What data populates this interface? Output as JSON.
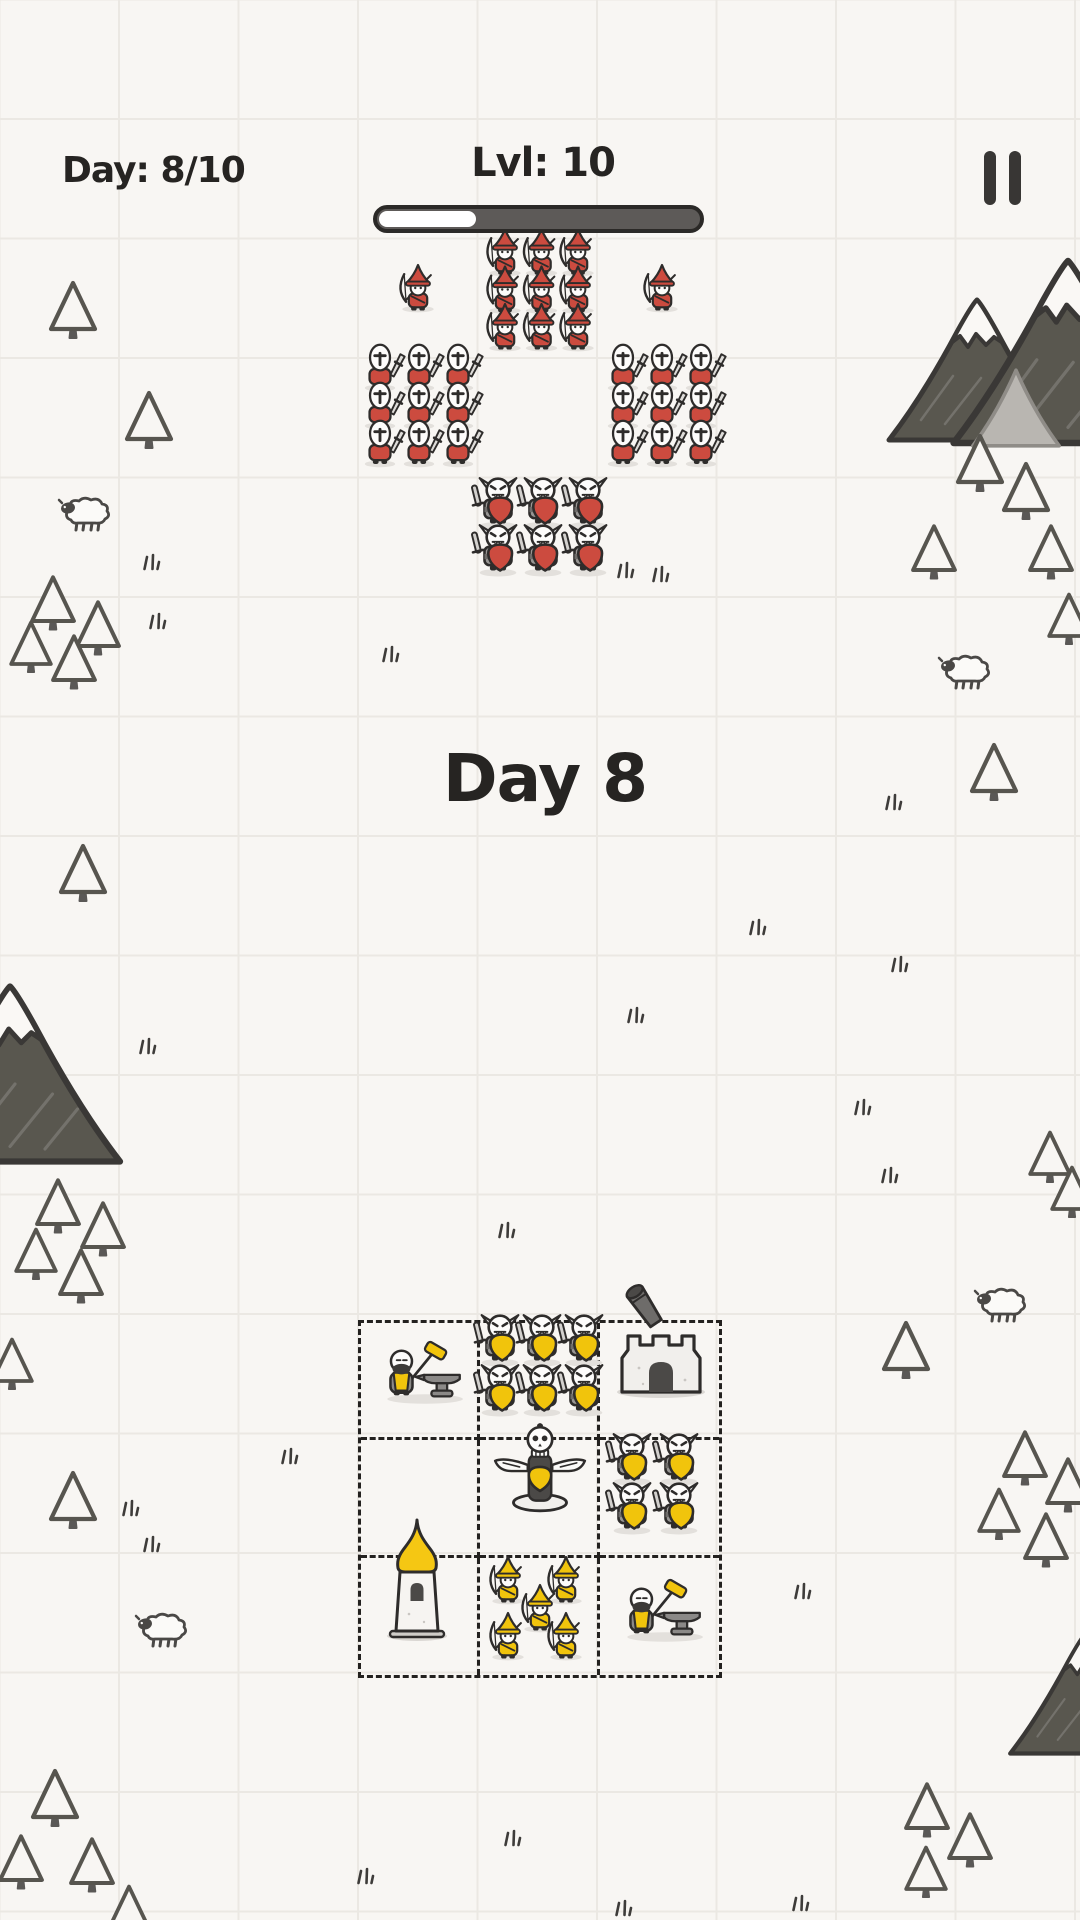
{
  "hud": {
    "day_counter": "Day: 8/10",
    "level_label": "Lvl: 10",
    "level_progress_percent": 30,
    "pause_icon": "pause"
  },
  "banner": {
    "day_title": "Day 8"
  },
  "colors": {
    "paper": "#f8f6f3",
    "grid_line": "#ebe8e3",
    "ink": "#2e2c2b",
    "enemy_red": "#cc4b3f",
    "player_yellow": "#f1c40c",
    "bar_track": "#5d5a58",
    "bar_fill": "#ffffff",
    "bar_border": "#2b2927"
  },
  "board": {
    "x": 358,
    "y": 1320,
    "width": 364,
    "height": 358,
    "rows": 3,
    "cols": 3,
    "cells": [
      [
        "blacksmith",
        "shield-warriors-x6",
        "cannon-tower"
      ],
      [
        "empty",
        "skull-totem",
        "shield-warriors-x4"
      ],
      [
        "spire-tower",
        "archers-x5",
        "blacksmith"
      ]
    ]
  },
  "units": [
    {
      "name": "enemy-archer",
      "type": "archer",
      "color": "#cc4b3f",
      "x": 505,
      "y": 252,
      "cols": 3,
      "rows": 3,
      "dx": 36.5,
      "dy": 37.5,
      "s": 0.92,
      "interactable": false
    },
    {
      "name": "enemy-archer-flank-left",
      "type": "archer",
      "color": "#cc4b3f",
      "x": 418,
      "y": 288,
      "s": 0.92,
      "interactable": false
    },
    {
      "name": "enemy-archer-flank-right",
      "type": "archer",
      "color": "#cc4b3f",
      "x": 662,
      "y": 288,
      "s": 0.92,
      "interactable": false
    },
    {
      "name": "enemy-swordsman-left",
      "type": "swordsman",
      "color": "#cc4b3f",
      "x": 380,
      "y": 368,
      "cols": 3,
      "rows": 3,
      "dx": 39,
      "dy": 38,
      "s": 0.95,
      "interactable": false
    },
    {
      "name": "enemy-swordsman-right",
      "type": "swordsman",
      "color": "#cc4b3f",
      "x": 623,
      "y": 368,
      "cols": 3,
      "rows": 3,
      "dx": 39,
      "dy": 38,
      "s": 0.95,
      "interactable": false
    },
    {
      "name": "enemy-shield-warrior",
      "type": "orc",
      "color": "#cc4b3f",
      "x": 498,
      "y": 503,
      "cols": 3,
      "rows": 2,
      "dx": 45,
      "dy": 47,
      "s": 1.08,
      "interactable": false
    },
    {
      "name": "player-blacksmith",
      "type": "blacksmith",
      "x": 423,
      "y": 1378,
      "s": 1.05,
      "interactable": true
    },
    {
      "name": "player-shield-warrior-squad6",
      "type": "orc",
      "color": "#f1c40c",
      "x": 500,
      "y": 1340,
      "cols": 3,
      "rows": 2,
      "dx": 42,
      "dy": 50,
      "s": 1.08,
      "interactable": true
    },
    {
      "name": "player-cannon-tower",
      "type": "cannon-tower",
      "x": 661,
      "y": 1356,
      "s": 1,
      "interactable": true
    },
    {
      "name": "player-skull-totem",
      "type": "totem",
      "x": 540,
      "y": 1469,
      "s": 1.02,
      "interactable": true
    },
    {
      "name": "player-shield-warrior-squad4",
      "type": "orc",
      "color": "#f1c40c",
      "x": 632,
      "y": 1459,
      "cols": 2,
      "rows": 2,
      "dx": 47,
      "dy": 49,
      "s": 1.08,
      "interactable": true
    },
    {
      "name": "player-spire-tower",
      "type": "spire-tower",
      "x": 417,
      "y": 1584,
      "s": 1,
      "interactable": true
    },
    {
      "name": "player-archer-squad5",
      "type": "archer",
      "color": "#f1c40c",
      "points": [
        [
          508,
          1580
        ],
        [
          566,
          1580
        ],
        [
          540,
          1608
        ],
        [
          508,
          1636
        ],
        [
          566,
          1636
        ]
      ],
      "s": 0.92,
      "interactable": true
    },
    {
      "name": "player-blacksmith-2",
      "type": "blacksmith",
      "x": 663,
      "y": 1616,
      "s": 1.05,
      "interactable": true
    }
  ],
  "decorations": {
    "mountains": [
      {
        "x": 977,
        "y": 370,
        "s": 1.0
      },
      {
        "x": 1068,
        "y": 352,
        "s": 1.3
      },
      {
        "x": 1016,
        "y": 408,
        "s": 0.9,
        "light": true
      },
      {
        "x": 10,
        "y": 1074,
        "s": 1.25
      },
      {
        "x": 1085,
        "y": 1694,
        "s": 0.85
      }
    ],
    "trees": [
      [
        73,
        309,
        1
      ],
      [
        149,
        419,
        1
      ],
      [
        53,
        602,
        0.95
      ],
      [
        98,
        627,
        0.95
      ],
      [
        31,
        646,
        0.9
      ],
      [
        74,
        661,
        0.95
      ],
      [
        980,
        462,
        1
      ],
      [
        1026,
        490,
        1
      ],
      [
        934,
        551,
        0.95
      ],
      [
        1051,
        551,
        0.95
      ],
      [
        1069,
        618,
        0.9
      ],
      [
        994,
        771,
        1
      ],
      [
        83,
        872,
        1
      ],
      [
        58,
        1205,
        0.95
      ],
      [
        103,
        1228,
        0.95
      ],
      [
        36,
        1253,
        0.9
      ],
      [
        81,
        1275,
        0.95
      ],
      [
        12,
        1363,
        0.9
      ],
      [
        1050,
        1156,
        0.9
      ],
      [
        1072,
        1191,
        0.9
      ],
      [
        906,
        1349,
        1
      ],
      [
        1025,
        1457,
        0.95
      ],
      [
        1068,
        1484,
        0.95
      ],
      [
        999,
        1513,
        0.9
      ],
      [
        1046,
        1539,
        0.95
      ],
      [
        73,
        1499,
        1
      ],
      [
        55,
        1797,
        1
      ],
      [
        21,
        1861,
        0.95
      ],
      [
        92,
        1864,
        0.95
      ],
      [
        927,
        1809,
        0.95
      ],
      [
        970,
        1839,
        0.95
      ],
      [
        926,
        1871,
        0.9
      ],
      [
        129,
        1910,
        0.9
      ]
    ],
    "sheep": [
      [
        88,
        514
      ],
      [
        968,
        672
      ],
      [
        1004,
        1305
      ],
      [
        165,
        1630
      ]
    ],
    "grass": [
      [
        153,
        563
      ],
      [
        159,
        622
      ],
      [
        392,
        655
      ],
      [
        627,
        571
      ],
      [
        662,
        575
      ],
      [
        895,
        803
      ],
      [
        759,
        928
      ],
      [
        901,
        965
      ],
      [
        637,
        1016
      ],
      [
        149,
        1047
      ],
      [
        864,
        1108
      ],
      [
        891,
        1176
      ],
      [
        508,
        1231
      ],
      [
        291,
        1457
      ],
      [
        132,
        1509
      ],
      [
        153,
        1545
      ],
      [
        804,
        1592
      ],
      [
        514,
        1839
      ],
      [
        367,
        1877
      ],
      [
        802,
        1904
      ],
      [
        625,
        1909
      ]
    ]
  }
}
